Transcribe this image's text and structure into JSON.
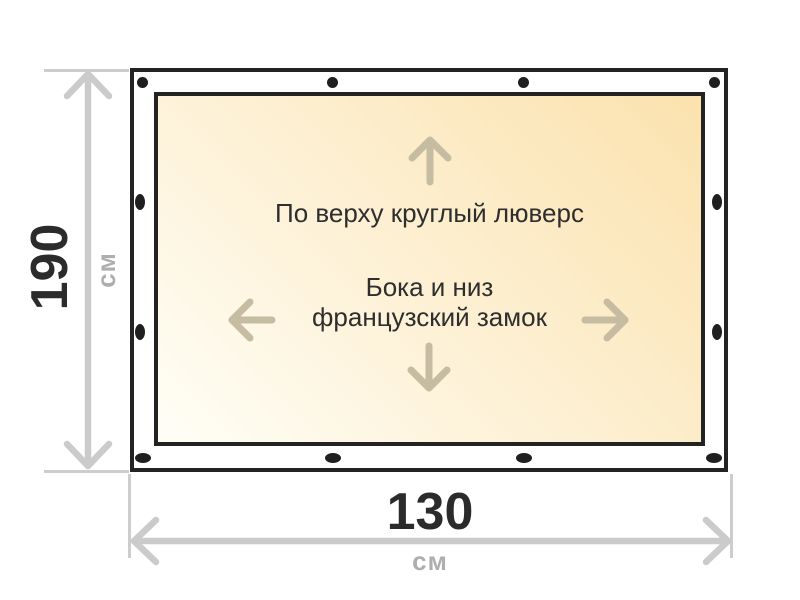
{
  "canvas": {
    "note_top": "По верху круглый люверс",
    "note_middle_line1": "Бока и низ",
    "note_middle_line2": "французский замок"
  },
  "dimensions": {
    "height": {
      "value": "190",
      "unit": "см"
    },
    "width": {
      "value": "130",
      "unit": "см"
    }
  },
  "icons": {
    "top_edge": "round-grommet-icon",
    "sides_and_bottom": "french-lock-slot-icon",
    "direction_arrows": [
      "arrow-up-icon",
      "arrow-left-icon",
      "arrow-right-icon",
      "arrow-down-icon"
    ]
  },
  "colors": {
    "border": "#232323",
    "canvas_gradient_start": "#fffef7",
    "canvas_gradient_end": "#fbe2ae",
    "direction_arrow": "#c6bca2",
    "dimension_line": "#cbcbcb",
    "unit_text": "#aeaeae",
    "number_text": "#2b2b2b",
    "grommet": "#1f1f1f"
  }
}
